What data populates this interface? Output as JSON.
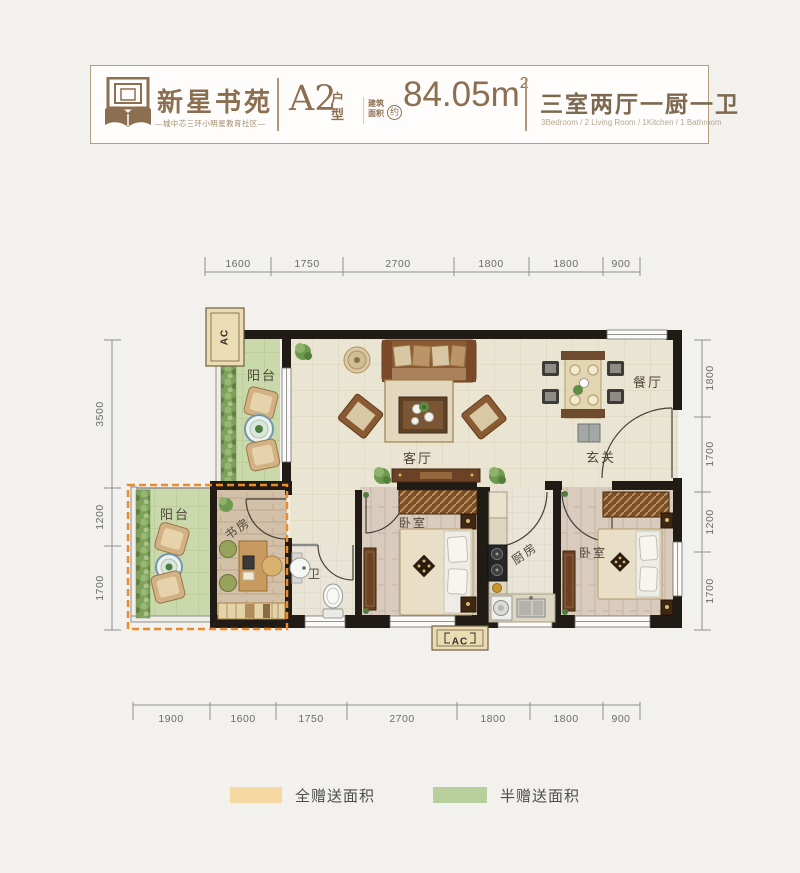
{
  "header": {
    "logo_name": "新星书苑",
    "logo_tagline": "—城中芯三环小明星教育社区—",
    "unit_code": "A2",
    "unit_type_label": "户型",
    "area_label": "建筑面积",
    "area_approx": "约",
    "area_value": "84.05",
    "area_unit": "m",
    "area_sup": "2",
    "layout_cn": "三室两厅一厨一卫",
    "layout_en": "3Bedroom / 2 Living Room / 1Kitchen / 1 Bathroom"
  },
  "rooms": {
    "balcony_top": "阳台",
    "living": "客厅",
    "dining": "餐厅",
    "entry": "玄关",
    "balcony_bottom": "阳台",
    "study": "书房",
    "bath": "卫",
    "bedroom_mid": "卧室",
    "kitchen": "厨房",
    "bedroom_right": "卧室"
  },
  "ac_label": "AC",
  "dimensions": {
    "top": [
      "1600",
      "1750",
      "2700",
      "1800",
      "1800",
      "900"
    ],
    "bottom": [
      "1900",
      "1600",
      "1750",
      "2700",
      "1800",
      "1800",
      "900"
    ],
    "left": [
      "3500",
      "1200",
      "1700"
    ],
    "right": [
      "1800",
      "1700",
      "1200",
      "1700"
    ]
  },
  "legend": {
    "full": {
      "label": "全赠送面积",
      "color": "#f6d9a2"
    },
    "half": {
      "label": "半赠送面积",
      "color": "#b7cf9b"
    }
  },
  "colors": {
    "gift_outline": "#ef8a28",
    "wall": "#211b15",
    "balcony_green": "#c9d9ab",
    "floor_tile": "#eae5d2",
    "brand_brown": "#8c6e50"
  }
}
